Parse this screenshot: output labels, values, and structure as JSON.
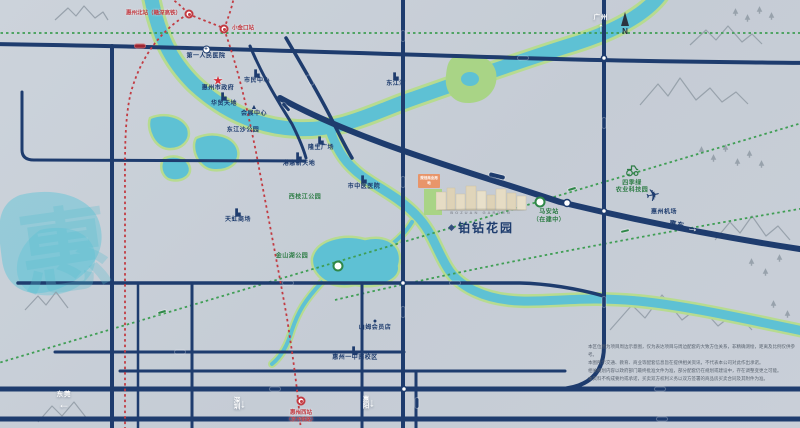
{
  "title": "铂钻花园 区位示意图",
  "compass": {
    "n": "N"
  },
  "watermark": "惠",
  "project": {
    "name": "铂钻花园",
    "latin": "BOZUAN GARDEN",
    "logo_glyph": "◆",
    "plan_block": "规划商业用地"
  },
  "districts": [
    {
      "text": "江北",
      "x": 302,
      "y": 57,
      "size": 13
    },
    {
      "text": "水口",
      "x": 427,
      "y": 88,
      "size": 12
    },
    {
      "text": "下角",
      "x": 126,
      "y": 164,
      "size": 12
    },
    {
      "text": "东平",
      "x": 337,
      "y": 168,
      "size": 12
    },
    {
      "text": "金山湖",
      "x": 325,
      "y": 262,
      "size": 12
    },
    {
      "text": "仲恺",
      "x": 62,
      "y": 316,
      "size": 12
    },
    {
      "text": "南部新城",
      "x": 352,
      "y": 379,
      "size": 9
    },
    {
      "text": "河南岸",
      "x": 257,
      "y": 210,
      "size": 8,
      "cls": "vert"
    },
    {
      "text": "麦地",
      "x": 269,
      "y": 213,
      "size": 8,
      "cls": "vert"
    }
  ],
  "water_labels": [
    {
      "text": "西湖",
      "x": 207,
      "y": 148,
      "size": 7
    },
    {
      "text": "红花湖",
      "x": 26,
      "y": 227,
      "size": 7,
      "color": "#3fb3c9"
    },
    {
      "text": "源溪公园",
      "x": 486,
      "y": 49,
      "size": 6.5,
      "color": "#2f5d9e"
    }
  ],
  "pois": [
    {
      "text": "第一人民医院",
      "x": 206,
      "y": 53,
      "icon": "+",
      "cls": "i-hosp"
    },
    {
      "text": "惠州市政府",
      "x": 218,
      "y": 84,
      "icon": "★",
      "cls": "i-star"
    },
    {
      "text": "市民中心",
      "x": 257,
      "y": 78,
      "icon": "▙"
    },
    {
      "text": "华贸天地",
      "x": 224,
      "y": 101,
      "icon": "▙"
    },
    {
      "text": "会展中心",
      "x": 254,
      "y": 111,
      "icon": "▲"
    },
    {
      "text": "东江沙公园",
      "x": 243,
      "y": 131
    },
    {
      "text": "隆生广场",
      "x": 321,
      "y": 145,
      "icon": "▙"
    },
    {
      "text": "港惠新天地",
      "x": 299,
      "y": 161,
      "icon": "▙"
    },
    {
      "text": "市中医医院",
      "x": 364,
      "y": 184,
      "icon": "▙"
    },
    {
      "text": "东江湾",
      "x": 396,
      "y": 81,
      "icon": "▙"
    },
    {
      "text": "天虹商场",
      "x": 238,
      "y": 217,
      "icon": "▙"
    },
    {
      "text": "山姆会员店",
      "x": 375,
      "y": 325,
      "icon": "●"
    },
    {
      "text": "惠州一中南校区",
      "x": 355,
      "y": 355,
      "icon": "▙"
    },
    {
      "text": "惠州机场",
      "x": 664,
      "y": 213
    },
    {
      "text": "西枝江公园",
      "x": 305,
      "y": 198,
      "color": "#2e7d46"
    },
    {
      "text": "金山湖公园",
      "x": 292,
      "y": 257,
      "color": "#2e7d46"
    },
    {
      "text": "马安站",
      "x": 549,
      "y": 213,
      "color": "#2e7d46"
    },
    {
      "text": "（在建中）",
      "x": 549,
      "y": 221,
      "color": "#2e7d46",
      "size": 5
    },
    {
      "text": "四季绿",
      "x": 632,
      "y": 184,
      "color": "#2e7d46",
      "size": 5.5
    },
    {
      "text": "农业科技园",
      "x": 632,
      "y": 191,
      "color": "#2e7d46",
      "size": 5.5
    }
  ],
  "road_pills": [
    {
      "text": "惠民大道",
      "x": 523,
      "y": 58
    },
    {
      "text": "惠州大道",
      "x": 497,
      "y": 176,
      "rot": 14,
      "cls": "pill-big"
    },
    {
      "text": "中信大桥",
      "x": 403,
      "y": 36,
      "rot": 90
    },
    {
      "text": "金山大道",
      "x": 403,
      "y": 182,
      "rot": 90
    },
    {
      "text": "金山大道",
      "x": 403,
      "y": 312,
      "rot": 90
    },
    {
      "text": "惠泽大道",
      "x": 604,
      "y": 123,
      "rot": 90
    },
    {
      "text": "惠泽大道",
      "x": 604,
      "y": 302,
      "rot": 90
    },
    {
      "text": "三环南路",
      "x": 288,
      "y": 283
    },
    {
      "text": "金山大桥",
      "x": 455,
      "y": 283
    },
    {
      "text": "四环南路",
      "x": 180,
      "y": 352
    },
    {
      "text": "隆生大桥",
      "x": 310,
      "y": 80,
      "rot": 62
    },
    {
      "text": "东江大桥",
      "x": 286,
      "y": 107,
      "rot": 48
    },
    {
      "text": "惠澳大道",
      "x": 417,
      "y": 403,
      "rot": 90
    },
    {
      "text": "惠莞高速",
      "x": 275,
      "y": 389
    },
    {
      "text": "惠莞高速",
      "x": 660,
      "y": 389
    },
    {
      "text": "深汕高速",
      "x": 662,
      "y": 419
    }
  ],
  "red_pills": [
    {
      "text": "金龙大道（在建中）",
      "x": 140,
      "y": 46
    }
  ],
  "green_pills": [
    {
      "text": "（在建）深惠城轨",
      "x": 572,
      "y": 189,
      "rot": -17
    },
    {
      "text": "（在建）深惠城轨",
      "x": 625,
      "y": 231,
      "rot": -13
    },
    {
      "text": "（在建）深惠城轨",
      "x": 162,
      "y": 312,
      "rot": -17
    }
  ],
  "rail_stations": [
    {
      "text": "惠州北站（赣深高铁）",
      "x": 189,
      "y": 14,
      "cls": "lbl-right"
    },
    {
      "text": "小金口站",
      "x": 224,
      "y": 29,
      "cls": "lbl-left"
    },
    {
      "text": "惠州西站",
      "sub": "（京九铁路）",
      "x": 301,
      "y": 401,
      "cls": "lbl-center"
    }
  ],
  "transit_icons": [
    {
      "glyph": "×",
      "x": 540,
      "y": 202
    },
    {
      "glyph": "×",
      "x": 338,
      "y": 266
    }
  ],
  "arrows": [
    {
      "glyph": "↑",
      "label": "广州",
      "x": 601,
      "y": 22,
      "cls": "a-up"
    },
    {
      "glyph": "←",
      "label": "东莞",
      "x": 64,
      "y": 399,
      "cls": "a-up"
    },
    {
      "glyph": "↓",
      "label": "深圳",
      "x": 237,
      "y": 403,
      "cls": "a-side"
    },
    {
      "glyph": "↓",
      "label": "惠阳",
      "x": 366,
      "y": 402,
      "cls": "a-side"
    },
    {
      "glyph": "→",
      "label": "惠东",
      "x": 684,
      "y": 226,
      "cls": "a-east",
      "rot": 10
    }
  ],
  "disclaimer": {
    "l1": "本区位图为项目周边示意图，仅为表达项目与周边配套的大致方位关系，非精确测绘，距离及比例仅供参考。",
    "l2": "本图所示交通、教育、商业等配套信息旨在提供相关资讯，不代表本公司对此作出承诺。",
    "l3": "相关规划内容以政府部门最终批准文件为准，部分配套仍在规划或建设中，存在调整变更之可能。",
    "l4": "本资料不构成要约或承诺，买卖双方权利义务以双方签署的商品房买卖合同及其附件为准。"
  }
}
